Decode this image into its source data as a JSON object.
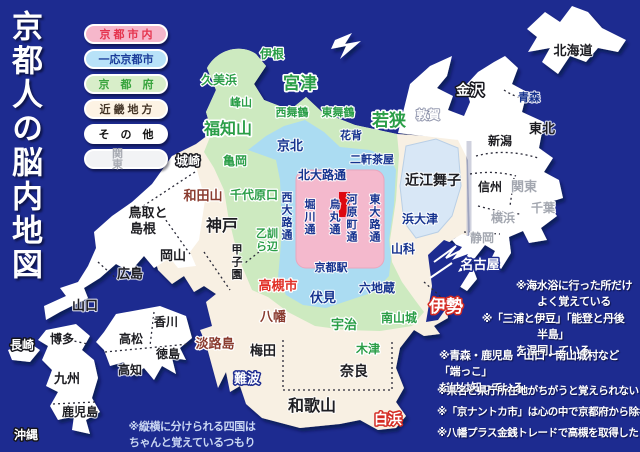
{
  "title": "京都人の脳内地図",
  "legend": {
    "items": [
      {
        "label": "京都市内",
        "bg": "#f6b7cb",
        "fg": "#e5344e"
      },
      {
        "label": "一応京都市",
        "bg": "#b8e2f8",
        "fg": "#1c3d9a"
      },
      {
        "label": "京都府",
        "bg": "#d8eec9",
        "fg": "#39a43e"
      },
      {
        "label": "近畿地方",
        "bg": "#fdf3e4",
        "fg": "#443527"
      },
      {
        "label": "その他",
        "bg": "#ffffff",
        "fg": "#111111"
      },
      {
        "label": "関東",
        "bg": "#f2f3f5",
        "fg": "#a8abb3"
      }
    ]
  },
  "notes": [
    "※海水浴に行った所だけ\nよく覚えている",
    "※「三浦と伊豆」「能登と丹後半島」\nを混同している",
    "※青森・鹿児島・山口・南山城村など「端っこ」\nだけは知っている",
    "※県名と県庁所在地がちがうと覚えられない",
    "※「京ナントカ市」は心の中で京都府から除名",
    "※八幡プラス金銭トレードで高槻を取得した",
    "※縦横に分けられる四国は\nちゃんと覚えているつもり"
  ],
  "colors": {
    "sea": "#1d2b90",
    "kinki": "#f8f0e3",
    "other_land": "#ffffff",
    "kyoto_pref": "#cdeac0",
    "kyoto_city_maybe": "#abdcf2",
    "kyoto_city": "#f4b9cd",
    "lake_biwa": "#d8e7f6",
    "red_marker": "#dd0710"
  },
  "map": {
    "labels": [
      {
        "id": "ine",
        "text": "伊根",
        "x": 272,
        "y": 58,
        "s": 12,
        "c": "g"
      },
      {
        "id": "miyazu",
        "text": "宮津",
        "x": 300,
        "y": 89,
        "s": 17,
        "c": "gB"
      },
      {
        "id": "kumihama",
        "text": "久美浜",
        "x": 219,
        "y": 84,
        "s": 12,
        "c": "g"
      },
      {
        "id": "mineyama",
        "text": "峰山",
        "x": 241,
        "y": 106,
        "s": 11,
        "c": "g"
      },
      {
        "id": "fukuchiyama",
        "text": "福知山",
        "x": 228,
        "y": 134,
        "s": 16,
        "c": "gB"
      },
      {
        "id": "kameoka",
        "text": "亀岡",
        "x": 235,
        "y": 165,
        "s": 12,
        "c": "g"
      },
      {
        "id": "nishi-maizuru",
        "text": "西舞鶴",
        "x": 292,
        "y": 116,
        "s": 11,
        "c": "g"
      },
      {
        "id": "higashi-maizuru",
        "text": "東舞鶴",
        "x": 338,
        "y": 116,
        "s": 11,
        "c": "g"
      },
      {
        "id": "wakasa",
        "text": "若狭",
        "x": 389,
        "y": 126,
        "s": 17,
        "c": "gB"
      },
      {
        "id": "tsuruga",
        "text": "敦賀",
        "x": 428,
        "y": 119,
        "s": 12,
        "c": "w"
      },
      {
        "id": "hanase",
        "text": "花背",
        "x": 351,
        "y": 139,
        "s": 11,
        "c": "nv"
      },
      {
        "id": "keihoku",
        "text": "京北",
        "x": 290,
        "y": 150,
        "s": 13,
        "c": "nv"
      },
      {
        "id": "nikenchaya",
        "text": "二軒茶屋",
        "x": 372,
        "y": 163,
        "s": 11,
        "c": "nv"
      },
      {
        "id": "kitaoji-dori",
        "text": "北大路通",
        "x": 322,
        "y": 179,
        "s": 12,
        "c": "nv"
      },
      {
        "id": "chiyoharaguchi",
        "text": "千代原口",
        "x": 254,
        "y": 199,
        "s": 12,
        "c": "g"
      },
      {
        "id": "nishioji-dori",
        "text": "西大路通",
        "x": 287,
        "y": 201,
        "s": 11,
        "c": "nv",
        "v": 1
      },
      {
        "id": "horikawa-dori",
        "text": "堀川通",
        "x": 310,
        "y": 208,
        "s": 11,
        "c": "nv",
        "v": 1
      },
      {
        "id": "karasuma-dori",
        "text": "烏丸通",
        "x": 335,
        "y": 208,
        "s": 11,
        "c": "nv",
        "v": 1
      },
      {
        "id": "kawaramachi-dori",
        "text": "河原町通",
        "x": 352,
        "y": 203,
        "s": 11,
        "c": "nv",
        "v": 1
      },
      {
        "id": "higashioji-dori",
        "text": "東大路通",
        "x": 375,
        "y": 203,
        "s": 11,
        "c": "nv",
        "v": 1
      },
      {
        "id": "kyoto-station",
        "text": "京都駅",
        "x": 331,
        "y": 271,
        "s": 11,
        "c": "nv"
      },
      {
        "id": "otokuni-1",
        "text": "乙訓",
        "x": 267,
        "y": 237,
        "s": 11,
        "c": "g"
      },
      {
        "id": "otokuni-2",
        "text": "ら辺",
        "x": 267,
        "y": 250,
        "s": 11,
        "c": "g"
      },
      {
        "id": "takatsuki-shi",
        "text": "高槻市",
        "x": 278,
        "y": 290,
        "s": 13,
        "c": "rd"
      },
      {
        "id": "fushimi",
        "text": "伏見",
        "x": 323,
        "y": 302,
        "s": 13,
        "c": "nv"
      },
      {
        "id": "rokujizo",
        "text": "六地蔵",
        "x": 377,
        "y": 292,
        "s": 12,
        "c": "nv"
      },
      {
        "id": "uji",
        "text": "宇治",
        "x": 344,
        "y": 329,
        "s": 13,
        "c": "g"
      },
      {
        "id": "minami-yamashiro",
        "text": "南山城",
        "x": 399,
        "y": 322,
        "s": 12,
        "c": "g"
      },
      {
        "id": "kizu",
        "text": "木津",
        "x": 368,
        "y": 353,
        "s": 12,
        "c": "g"
      },
      {
        "id": "yamashina",
        "text": "山科",
        "x": 403,
        "y": 253,
        "s": 12,
        "c": "nv"
      },
      {
        "id": "hamaotsu",
        "text": "浜大津",
        "x": 420,
        "y": 223,
        "s": 12,
        "c": "nv"
      },
      {
        "id": "omi-maiko",
        "text": "近江舞子",
        "x": 433,
        "y": 185,
        "s": 14,
        "c": "bk"
      },
      {
        "id": "kinosaki",
        "text": "城崎",
        "x": 188,
        "y": 165,
        "s": 12,
        "c": "wb"
      },
      {
        "id": "wadayama",
        "text": "和田山",
        "x": 203,
        "y": 200,
        "s": 13,
        "c": "mr"
      },
      {
        "id": "kobe",
        "text": "神戸",
        "x": 222,
        "y": 231,
        "s": 16,
        "c": "bk"
      },
      {
        "id": "koshien",
        "text": "甲子園",
        "x": 237,
        "y": 253,
        "s": 11,
        "c": "bk",
        "v": 1
      },
      {
        "id": "tottori-1",
        "text": "鳥取と",
        "x": 148,
        "y": 217,
        "s": 13,
        "c": "bk"
      },
      {
        "id": "tottori-2",
        "text": "島根",
        "x": 143,
        "y": 233,
        "s": 13,
        "c": "bk"
      },
      {
        "id": "okayama",
        "text": "岡山",
        "x": 173,
        "y": 260,
        "s": 13,
        "c": "bk"
      },
      {
        "id": "hiroshima",
        "text": "広島",
        "x": 130,
        "y": 278,
        "s": 13,
        "c": "bk"
      },
      {
        "id": "yamaguchi",
        "text": "山口",
        "x": 85,
        "y": 310,
        "s": 13,
        "c": "bk"
      },
      {
        "id": "yawata",
        "text": "八幡",
        "x": 273,
        "y": 321,
        "s": 13,
        "c": "mr"
      },
      {
        "id": "awajishima",
        "text": "淡路島",
        "x": 215,
        "y": 348,
        "s": 13,
        "c": "mr"
      },
      {
        "id": "umeda",
        "text": "梅田",
        "x": 263,
        "y": 355,
        "s": 13,
        "c": "bk"
      },
      {
        "id": "namba",
        "text": "難波",
        "x": 247,
        "y": 383,
        "s": 13,
        "c": "wn"
      },
      {
        "id": "nara",
        "text": "奈良",
        "x": 354,
        "y": 376,
        "s": 14,
        "c": "bk"
      },
      {
        "id": "wakayama",
        "text": "和歌山",
        "x": 312,
        "y": 411,
        "s": 16,
        "c": "bk"
      },
      {
        "id": "shirahama",
        "text": "白浜",
        "x": 388,
        "y": 424,
        "s": 14,
        "c": "wr"
      },
      {
        "id": "ise",
        "text": "伊勢",
        "x": 446,
        "y": 312,
        "s": 17,
        "c": "wr"
      },
      {
        "id": "nagoya",
        "text": "名古屋",
        "x": 480,
        "y": 269,
        "s": 13,
        "c": "wn"
      },
      {
        "id": "kanazawa",
        "text": "金沢",
        "x": 470,
        "y": 95,
        "s": 14,
        "c": "wb"
      },
      {
        "id": "hokkaido",
        "text": "北海道",
        "x": 573,
        "y": 55,
        "s": 13,
        "c": "bk"
      },
      {
        "id": "aomori",
        "text": "青森",
        "x": 529,
        "y": 101,
        "s": 11,
        "c": "nv"
      },
      {
        "id": "tohoku",
        "text": "東北",
        "x": 542,
        "y": 133,
        "s": 13,
        "c": "bk"
      },
      {
        "id": "niigata",
        "text": "新潟",
        "x": 500,
        "y": 145,
        "s": 12,
        "c": "bk"
      },
      {
        "id": "shinshu",
        "text": "信州",
        "x": 490,
        "y": 191,
        "s": 12,
        "c": "bk"
      },
      {
        "id": "kanto",
        "text": "関東",
        "x": 524,
        "y": 191,
        "s": 13,
        "c": "gy"
      },
      {
        "id": "chiba",
        "text": "千葉",
        "x": 543,
        "y": 212,
        "s": 12,
        "c": "gy"
      },
      {
        "id": "yokohama",
        "text": "横浜",
        "x": 503,
        "y": 222,
        "s": 12,
        "c": "gy"
      },
      {
        "id": "shizuoka",
        "text": "静岡",
        "x": 482,
        "y": 242,
        "s": 12,
        "c": "gy"
      },
      {
        "id": "hakata",
        "text": "博多",
        "x": 62,
        "y": 343,
        "s": 12,
        "c": "bk"
      },
      {
        "id": "nagasaki",
        "text": "長崎",
        "x": 22,
        "y": 349,
        "s": 12,
        "c": "wb"
      },
      {
        "id": "kyushu",
        "text": "九州",
        "x": 67,
        "y": 383,
        "s": 13,
        "c": "bk"
      },
      {
        "id": "kagoshima",
        "text": "鹿児島",
        "x": 80,
        "y": 416,
        "s": 12,
        "c": "bk"
      },
      {
        "id": "okinawa",
        "text": "沖縄",
        "x": 26,
        "y": 439,
        "s": 12,
        "c": "wb"
      },
      {
        "id": "kagawa",
        "text": "香川",
        "x": 166,
        "y": 326,
        "s": 12,
        "c": "bk"
      },
      {
        "id": "takamatsu",
        "text": "高松",
        "x": 131,
        "y": 343,
        "s": 12,
        "c": "bk"
      },
      {
        "id": "tokushima",
        "text": "徳島",
        "x": 168,
        "y": 358,
        "s": 12,
        "c": "bk"
      },
      {
        "id": "kochi",
        "text": "高知",
        "x": 130,
        "y": 374,
        "s": 12,
        "c": "bk"
      }
    ]
  }
}
